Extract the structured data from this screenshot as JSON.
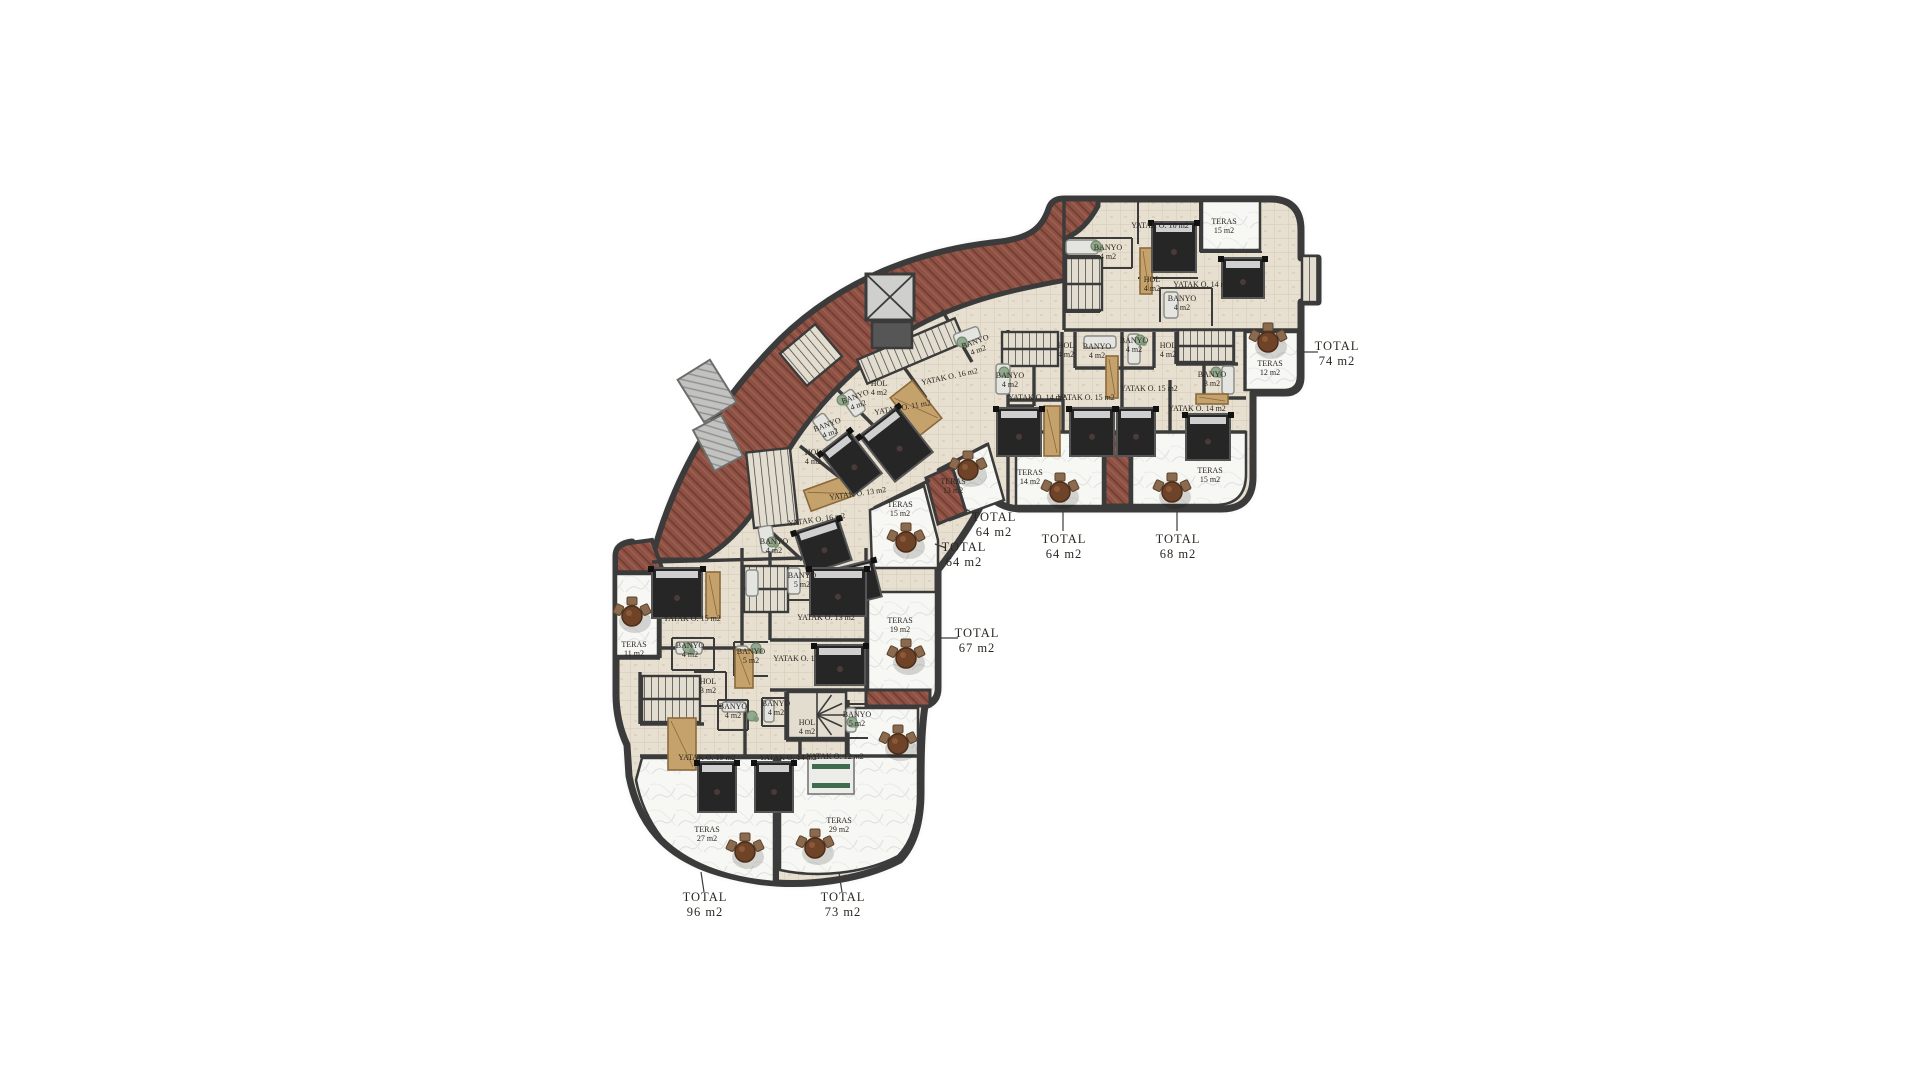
{
  "title": "Apartment floor plan",
  "units_totals": [
    "74 m2",
    "64 m2",
    "68 m2",
    "64 m2",
    "64 m2",
    "67 m2",
    "96 m2",
    "73 m2"
  ],
  "colors": {
    "wall": "#3b3b3b",
    "brick": "#8e5144",
    "brick_dark": "#6f3c32",
    "brick_light": "#9d6354",
    "floor": "#e7dfd0",
    "floor_grid": "#cfc3ae",
    "terrace": "#f7f7f3",
    "marble": "#d9dcdf",
    "bed": "#262626",
    "bed_frame": "#555555",
    "wood": "#c5a26b",
    "wood_dark": "#8a6a3c",
    "table": "#6f4328",
    "chair": "#8a6b4f",
    "stair_fill": "#e3ddd0",
    "gray_panel": "#c2c2c0",
    "text": "#2b2620",
    "plant": "#93a98f"
  },
  "labels": [
    {
      "t": [
        "YATAK O. 10 m2"
      ],
      "x": 1160,
      "y": 228
    },
    {
      "t": [
        "TERAS",
        "15 m2"
      ],
      "x": 1224,
      "y": 224
    },
    {
      "t": [
        "BANYO",
        "4 m2"
      ],
      "x": 1108,
      "y": 250
    },
    {
      "t": [
        "HOL",
        "4 m2"
      ],
      "x": 1152,
      "y": 282
    },
    {
      "t": [
        "YATAK O. 14 m2"
      ],
      "x": 1202,
      "y": 287
    },
    {
      "t": [
        "BANYO",
        "4 m2"
      ],
      "x": 1182,
      "y": 301
    },
    {
      "t": [
        "TERAS",
        "12 m2"
      ],
      "x": 1270,
      "y": 366
    },
    {
      "t": [
        "HOL",
        "4 m2"
      ],
      "x": 1066,
      "y": 348
    },
    {
      "t": [
        "BANYO",
        "4 m2"
      ],
      "x": 1097,
      "y": 349
    },
    {
      "t": [
        "BANYO",
        "4 m2"
      ],
      "x": 1010,
      "y": 378
    },
    {
      "t": [
        "YATAK O. 14 m2"
      ],
      "x": 1037,
      "y": 400
    },
    {
      "t": [
        "YATAK O. 15 m2"
      ],
      "x": 1086,
      "y": 400
    },
    {
      "t": [
        "TERAS",
        "14 m2"
      ],
      "x": 1030,
      "y": 475
    },
    {
      "t": [
        "BANYO",
        "4 m2"
      ],
      "x": 1134,
      "y": 343
    },
    {
      "t": [
        "HOL",
        "4 m2"
      ],
      "x": 1168,
      "y": 348
    },
    {
      "t": [
        "YATAK O. 15 m2"
      ],
      "x": 1149,
      "y": 391
    },
    {
      "t": [
        "YATAK O. 14 m2"
      ],
      "x": 1197,
      "y": 411
    },
    {
      "t": [
        "BANYO",
        "3 m2"
      ],
      "x": 1212,
      "y": 377
    },
    {
      "t": [
        "TERAS",
        "15 m2"
      ],
      "x": 1210,
      "y": 473
    },
    {
      "t": [
        "BANYO",
        "4 m2"
      ],
      "x": 976,
      "y": 344,
      "r": -20
    },
    {
      "t": [
        "YATAK O. 16 m2"
      ],
      "x": 950,
      "y": 379,
      "r": -12
    },
    {
      "t": [
        "HOL",
        "4 m2"
      ],
      "x": 879,
      "y": 386
    },
    {
      "t": [
        "BANYO",
        "4 m2"
      ],
      "x": 856,
      "y": 399,
      "r": -20
    },
    {
      "t": [
        "YATAK O. 11 m2"
      ],
      "x": 903,
      "y": 410,
      "r": -10
    },
    {
      "t": [
        "TERAS",
        "13 m2"
      ],
      "x": 953,
      "y": 484
    },
    {
      "t": [
        "BANYO",
        "4 m2"
      ],
      "x": 828,
      "y": 427,
      "r": -20
    },
    {
      "t": [
        "HOL",
        "4 m2"
      ],
      "x": 813,
      "y": 455
    },
    {
      "t": [
        "YATAK O. 13 m2"
      ],
      "x": 858,
      "y": 496,
      "r": -8
    },
    {
      "t": [
        "YATAK O. 16 m2"
      ],
      "x": 817,
      "y": 522,
      "r": -8
    },
    {
      "t": [
        "BANYO",
        "4 m2"
      ],
      "x": 774,
      "y": 544
    },
    {
      "t": [
        "TERAS",
        "15 m2"
      ],
      "x": 900,
      "y": 507
    },
    {
      "t": [
        "BANYO",
        "5 m2"
      ],
      "x": 802,
      "y": 578
    },
    {
      "t": [
        "YATAK O. 15 m2"
      ],
      "x": 692,
      "y": 621
    },
    {
      "t": [
        "YATAK O. 13 m2"
      ],
      "x": 826,
      "y": 620
    },
    {
      "t": [
        "TERAS",
        "11 m2"
      ],
      "x": 634,
      "y": 647
    },
    {
      "t": [
        "BANYO",
        "4 m2"
      ],
      "x": 690,
      "y": 648
    },
    {
      "t": [
        "HOL",
        "3 m2"
      ],
      "x": 708,
      "y": 684
    },
    {
      "t": [
        "BANYO",
        "5 m2"
      ],
      "x": 751,
      "y": 654
    },
    {
      "t": [
        "YATAK O. 17 m2"
      ],
      "x": 802,
      "y": 661
    },
    {
      "t": [
        "TERAS",
        "19 m2"
      ],
      "x": 900,
      "y": 623
    },
    {
      "t": [
        "BANYO",
        "4 m2"
      ],
      "x": 733,
      "y": 709
    },
    {
      "t": [
        "BANYO",
        "4 m2"
      ],
      "x": 776,
      "y": 706
    },
    {
      "t": [
        "HOL",
        "4 m2"
      ],
      "x": 807,
      "y": 725
    },
    {
      "t": [
        "BANYO",
        "5 m2"
      ],
      "x": 857,
      "y": 717
    },
    {
      "t": [
        "YATAK O. 19 m2"
      ],
      "x": 707,
      "y": 760
    },
    {
      "t": [
        "YATAK O. 14 m2"
      ],
      "x": 788,
      "y": 760
    },
    {
      "t": [
        "YATAK O. 12 m2"
      ],
      "x": 835,
      "y": 759
    },
    {
      "t": [
        "TERAS",
        "27 m2"
      ],
      "x": 707,
      "y": 832
    },
    {
      "t": [
        "TERAS",
        "29 m2"
      ],
      "x": 839,
      "y": 823
    }
  ],
  "totals": [
    {
      "t": [
        "TOTAL",
        "74 m2"
      ],
      "x": 1337,
      "y": 350,
      "leader": [
        1302,
        352,
        1318,
        352
      ]
    },
    {
      "t": [
        "TOTAL",
        "64 m2"
      ],
      "x": 1064,
      "y": 543,
      "leader": [
        1063,
        510,
        1063,
        531
      ]
    },
    {
      "t": [
        "TOTAL",
        "68 m2"
      ],
      "x": 1178,
      "y": 543,
      "leader": [
        1177,
        510,
        1177,
        531
      ]
    },
    {
      "t": [
        "TOTAL",
        "64 m2"
      ],
      "x": 994,
      "y": 521,
      "leader": [
        964,
        508,
        978,
        516
      ]
    },
    {
      "t": [
        "TOTAL",
        "64 m2"
      ],
      "x": 964,
      "y": 551,
      "leader": [
        935,
        544,
        946,
        548
      ]
    },
    {
      "t": [
        "TOTAL",
        "67 m2"
      ],
      "x": 977,
      "y": 637,
      "leader": [
        940,
        638,
        958,
        638
      ]
    },
    {
      "t": [
        "TOTAL",
        "96 m2"
      ],
      "x": 705,
      "y": 901,
      "leader": [
        701,
        872,
        704,
        892
      ]
    },
    {
      "t": [
        "TOTAL",
        "73 m2"
      ],
      "x": 843,
      "y": 901,
      "leader": [
        839,
        873,
        842,
        892
      ]
    }
  ],
  "stairs": [
    [
      1066,
      258,
      36,
      52,
      0,
      "u"
    ],
    [
      1302,
      256,
      16,
      46,
      0,
      "run"
    ],
    [
      1002,
      332,
      56,
      34,
      0,
      "u"
    ],
    [
      1178,
      330,
      56,
      32,
      0,
      "u"
    ],
    [
      858,
      338,
      106,
      26,
      -23,
      "run"
    ],
    [
      788,
      334,
      46,
      42,
      -40,
      "run"
    ],
    [
      750,
      450,
      44,
      76,
      -6,
      "run"
    ],
    [
      744,
      566,
      44,
      46,
      0,
      "u"
    ],
    [
      642,
      676,
      58,
      46,
      0,
      "u"
    ],
    [
      788,
      692,
      58,
      46,
      0,
      "spiral"
    ]
  ],
  "skylights": [
    [
      688,
      366,
      38,
      50,
      -32
    ],
    [
      702,
      420,
      32,
      46,
      -28
    ]
  ],
  "elevator": {
    "x": 866,
    "y": 274,
    "w": 48,
    "h": 46,
    "shaft": [
      872,
      322,
      40,
      26
    ]
  },
  "beds": [
    [
      1152,
      222,
      44,
      50,
      0,
      "dark"
    ],
    [
      1222,
      258,
      42,
      40,
      0,
      "dark"
    ],
    [
      997,
      408,
      44,
      48,
      0,
      "dark"
    ],
    [
      1070,
      408,
      44,
      48,
      0,
      "dark"
    ],
    [
      1117,
      408,
      38,
      48,
      0,
      "dark"
    ],
    [
      1186,
      414,
      44,
      46,
      0,
      "dark"
    ],
    [
      872,
      415,
      48,
      58,
      -38,
      "dark"
    ],
    [
      833,
      436,
      36,
      54,
      -38,
      "dark"
    ],
    [
      800,
      524,
      46,
      44,
      -18,
      "dark"
    ],
    [
      820,
      566,
      58,
      38,
      -14,
      "dark"
    ],
    [
      652,
      568,
      50,
      50,
      0,
      "dark"
    ],
    [
      810,
      568,
      56,
      48,
      0,
      "dark"
    ],
    [
      815,
      645,
      50,
      40,
      0,
      "dark"
    ],
    [
      698,
      762,
      38,
      50,
      0,
      "dark"
    ],
    [
      755,
      762,
      38,
      50,
      0,
      "dark"
    ],
    [
      808,
      758,
      46,
      36,
      0,
      "light"
    ]
  ],
  "wood": [
    [
      1140,
      248,
      12,
      46,
      0
    ],
    [
      1044,
      406,
      16,
      50,
      0
    ],
    [
      1196,
      394,
      32,
      10,
      0
    ],
    [
      1106,
      356,
      12,
      42,
      0
    ],
    [
      902,
      384,
      28,
      48,
      -38
    ],
    [
      806,
      482,
      46,
      22,
      -20
    ],
    [
      706,
      572,
      14,
      46,
      0
    ],
    [
      735,
      650,
      18,
      38,
      0
    ],
    [
      668,
      718,
      28,
      52,
      0
    ]
  ],
  "tubs": [
    [
      1066,
      240,
      32,
      14,
      0
    ],
    [
      1164,
      292,
      14,
      26,
      0
    ],
    [
      996,
      364,
      14,
      30,
      0
    ],
    [
      1084,
      336,
      32,
      12,
      0
    ],
    [
      1128,
      334,
      12,
      30,
      0
    ],
    [
      1222,
      366,
      12,
      28,
      0
    ],
    [
      954,
      330,
      26,
      12,
      -20
    ],
    [
      846,
      390,
      14,
      26,
      -35
    ],
    [
      818,
      414,
      14,
      26,
      -35
    ],
    [
      760,
      526,
      14,
      26,
      -10
    ],
    [
      746,
      570,
      12,
      26,
      0
    ],
    [
      676,
      642,
      26,
      12,
      0
    ],
    [
      736,
      646,
      12,
      24,
      0
    ],
    [
      788,
      568,
      12,
      26,
      0
    ],
    [
      722,
      702,
      24,
      10,
      0
    ],
    [
      764,
      700,
      10,
      22,
      0
    ],
    [
      846,
      708,
      10,
      24,
      0
    ]
  ],
  "plants": [
    [
      1096,
      246
    ],
    [
      1140,
      340
    ],
    [
      1004,
      372
    ],
    [
      1216,
      372
    ],
    [
      962,
      342
    ],
    [
      842,
      400
    ],
    [
      772,
      542
    ],
    [
      688,
      648
    ],
    [
      756,
      648
    ],
    [
      752,
      716
    ],
    [
      852,
      722
    ]
  ],
  "tables": [
    [
      1268,
      342
    ],
    [
      1060,
      492
    ],
    [
      1172,
      492
    ],
    [
      968,
      470
    ],
    [
      906,
      542
    ],
    [
      906,
      658
    ],
    [
      898,
      744
    ],
    [
      745,
      852
    ],
    [
      815,
      848
    ],
    [
      632,
      616
    ]
  ]
}
